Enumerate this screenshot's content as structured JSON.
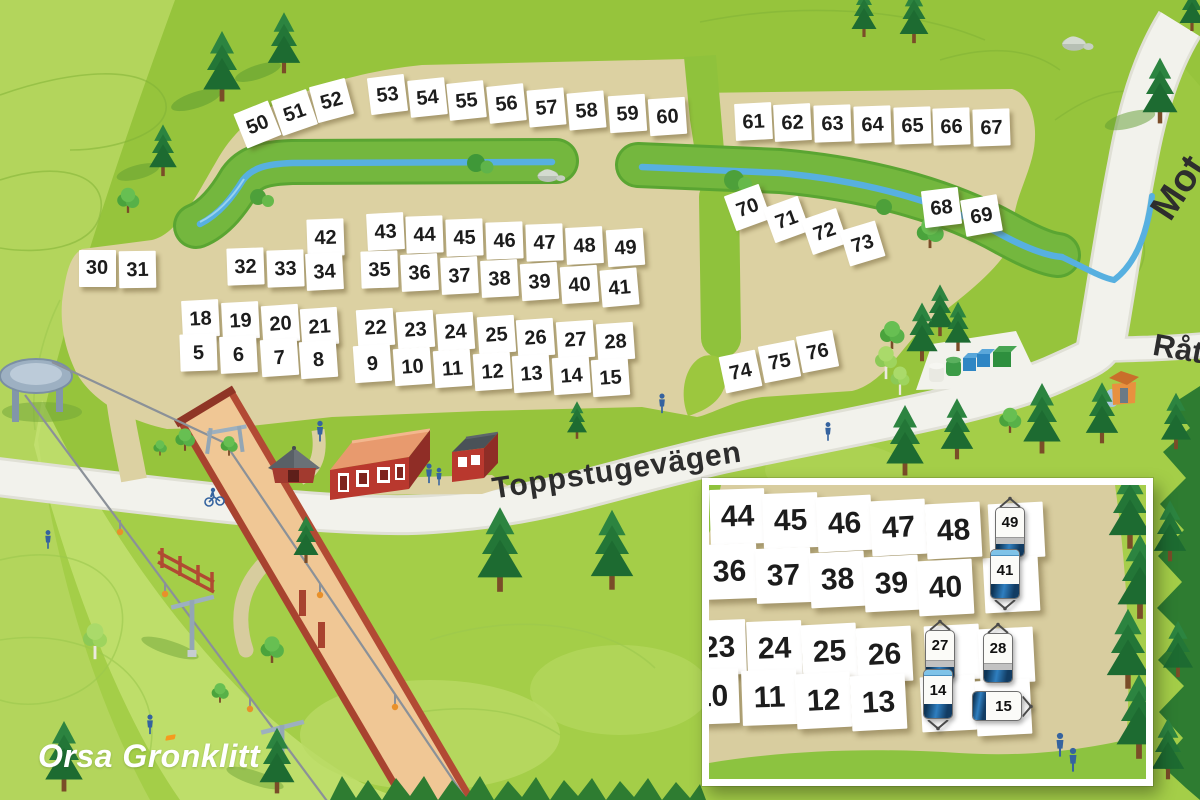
{
  "map": {
    "logo": {
      "text": "Orsa Grönklitt",
      "p1": "Orsa Gr",
      "o": "o",
      "p2": "nklitt"
    },
    "road_labels": {
      "main": "Toppstugevägen",
      "top_right": "Mot",
      "right": "Råt"
    },
    "plots": [
      {
        "n": "50",
        "x": 257,
        "y": 124,
        "r": -22
      },
      {
        "n": "51",
        "x": 294,
        "y": 112,
        "r": -19
      },
      {
        "n": "52",
        "x": 331,
        "y": 100,
        "r": -15
      },
      {
        "n": "53",
        "x": 387,
        "y": 94,
        "r": -7
      },
      {
        "n": "54",
        "x": 427,
        "y": 97,
        "r": -6
      },
      {
        "n": "55",
        "x": 466,
        "y": 100,
        "r": -6
      },
      {
        "n": "56",
        "x": 506,
        "y": 103,
        "r": -6
      },
      {
        "n": "57",
        "x": 546,
        "y": 107,
        "r": -5
      },
      {
        "n": "58",
        "x": 586,
        "y": 110,
        "r": -5
      },
      {
        "n": "59",
        "x": 627,
        "y": 113,
        "r": -4
      },
      {
        "n": "60",
        "x": 667,
        "y": 116,
        "r": -4
      },
      {
        "n": "61",
        "x": 753,
        "y": 121,
        "r": -3
      },
      {
        "n": "62",
        "x": 792,
        "y": 122,
        "r": -3
      },
      {
        "n": "63",
        "x": 832,
        "y": 123,
        "r": -2
      },
      {
        "n": "64",
        "x": 872,
        "y": 124,
        "r": -2
      },
      {
        "n": "65",
        "x": 912,
        "y": 125,
        "r": -2
      },
      {
        "n": "66",
        "x": 951,
        "y": 126,
        "r": -2
      },
      {
        "n": "67",
        "x": 991,
        "y": 127,
        "r": -2
      },
      {
        "n": "68",
        "x": 941,
        "y": 207,
        "r": -7
      },
      {
        "n": "69",
        "x": 981,
        "y": 215,
        "r": -10
      },
      {
        "n": "70",
        "x": 747,
        "y": 207,
        "r": -20
      },
      {
        "n": "71",
        "x": 786,
        "y": 219,
        "r": -20
      },
      {
        "n": "72",
        "x": 824,
        "y": 231,
        "r": -19
      },
      {
        "n": "73",
        "x": 862,
        "y": 243,
        "r": -17
      },
      {
        "n": "42",
        "x": 325,
        "y": 237,
        "r": -2
      },
      {
        "n": "43",
        "x": 385,
        "y": 231,
        "r": -3
      },
      {
        "n": "44",
        "x": 424,
        "y": 234,
        "r": -2
      },
      {
        "n": "45",
        "x": 464,
        "y": 237,
        "r": -2
      },
      {
        "n": "46",
        "x": 504,
        "y": 240,
        "r": -2
      },
      {
        "n": "47",
        "x": 544,
        "y": 242,
        "r": -2
      },
      {
        "n": "48",
        "x": 584,
        "y": 245,
        "r": -3
      },
      {
        "n": "49",
        "x": 625,
        "y": 247,
        "r": -4
      },
      {
        "n": "30",
        "x": 97,
        "y": 268,
        "r": 0
      },
      {
        "n": "31",
        "x": 137,
        "y": 269,
        "r": -1
      },
      {
        "n": "32",
        "x": 245,
        "y": 266,
        "r": -2
      },
      {
        "n": "33",
        "x": 285,
        "y": 268,
        "r": -2
      },
      {
        "n": "34",
        "x": 324,
        "y": 271,
        "r": -3
      },
      {
        "n": "35",
        "x": 379,
        "y": 269,
        "r": -2
      },
      {
        "n": "36",
        "x": 419,
        "y": 272,
        "r": -3
      },
      {
        "n": "37",
        "x": 459,
        "y": 275,
        "r": -3
      },
      {
        "n": "38",
        "x": 499,
        "y": 278,
        "r": -3
      },
      {
        "n": "39",
        "x": 539,
        "y": 281,
        "r": -4
      },
      {
        "n": "40",
        "x": 579,
        "y": 284,
        "r": -4
      },
      {
        "n": "41",
        "x": 619,
        "y": 287,
        "r": -5
      },
      {
        "n": "18",
        "x": 200,
        "y": 318,
        "r": -3
      },
      {
        "n": "19",
        "x": 240,
        "y": 320,
        "r": -3
      },
      {
        "n": "20",
        "x": 280,
        "y": 323,
        "r": -4
      },
      {
        "n": "21",
        "x": 319,
        "y": 326,
        "r": -4
      },
      {
        "n": "5",
        "x": 198,
        "y": 352,
        "r": -2
      },
      {
        "n": "6",
        "x": 238,
        "y": 354,
        "r": -3
      },
      {
        "n": "7",
        "x": 279,
        "y": 357,
        "r": -4
      },
      {
        "n": "8",
        "x": 318,
        "y": 359,
        "r": -4
      },
      {
        "n": "22",
        "x": 375,
        "y": 327,
        "r": -4
      },
      {
        "n": "23",
        "x": 415,
        "y": 329,
        "r": -4
      },
      {
        "n": "24",
        "x": 455,
        "y": 331,
        "r": -4
      },
      {
        "n": "25",
        "x": 496,
        "y": 334,
        "r": -4
      },
      {
        "n": "26",
        "x": 535,
        "y": 337,
        "r": -4
      },
      {
        "n": "27",
        "x": 575,
        "y": 339,
        "r": -4
      },
      {
        "n": "28",
        "x": 615,
        "y": 341,
        "r": -4
      },
      {
        "n": "9",
        "x": 372,
        "y": 363,
        "r": -4
      },
      {
        "n": "10",
        "x": 412,
        "y": 366,
        "r": -4
      },
      {
        "n": "11",
        "x": 452,
        "y": 368,
        "r": -4
      },
      {
        "n": "12",
        "x": 492,
        "y": 371,
        "r": -4
      },
      {
        "n": "13",
        "x": 531,
        "y": 373,
        "r": -4
      },
      {
        "n": "14",
        "x": 571,
        "y": 375,
        "r": -4
      },
      {
        "n": "15",
        "x": 610,
        "y": 377,
        "r": -4
      },
      {
        "n": "74",
        "x": 740,
        "y": 371,
        "r": -12
      },
      {
        "n": "75",
        "x": 779,
        "y": 361,
        "r": -11
      },
      {
        "n": "76",
        "x": 817,
        "y": 351,
        "r": -11
      }
    ]
  },
  "inset": {
    "plots": [
      {
        "n": "44",
        "x": 28,
        "y": 31,
        "r": -2
      },
      {
        "n": "45",
        "x": 81,
        "y": 35,
        "r": -2
      },
      {
        "n": "46",
        "x": 135,
        "y": 38,
        "r": -3
      },
      {
        "n": "47",
        "x": 189,
        "y": 42,
        "r": -3
      },
      {
        "n": "48",
        "x": 244,
        "y": 45,
        "r": -3
      },
      {
        "n": "36",
        "x": 20,
        "y": 86,
        "r": -2
      },
      {
        "n": "37",
        "x": 74,
        "y": 90,
        "r": -2
      },
      {
        "n": "38",
        "x": 128,
        "y": 94,
        "r": -3
      },
      {
        "n": "39",
        "x": 182,
        "y": 98,
        "r": -3
      },
      {
        "n": "40",
        "x": 236,
        "y": 102,
        "r": -3
      },
      {
        "n": "23",
        "x": 9,
        "y": 162,
        "r": -2
      },
      {
        "n": "24",
        "x": 65,
        "y": 163,
        "r": -2
      },
      {
        "n": "25",
        "x": 120,
        "y": 166,
        "r": -3
      },
      {
        "n": "26",
        "x": 175,
        "y": 169,
        "r": -3
      },
      {
        "n": "10",
        "x": 2,
        "y": 211,
        "r": -2
      },
      {
        "n": "11",
        "x": 60,
        "y": 212,
        "r": -2
      },
      {
        "n": "12",
        "x": 114,
        "y": 215,
        "r": -3
      },
      {
        "n": "13",
        "x": 169,
        "y": 217,
        "r": -3
      }
    ],
    "squares": [
      {
        "x": 307,
        "y": 45,
        "r": -3
      },
      {
        "x": 302,
        "y": 99,
        "r": -3
      },
      {
        "x": 243,
        "y": 167,
        "r": -3
      },
      {
        "x": 297,
        "y": 170,
        "r": -3
      },
      {
        "x": 239,
        "y": 218,
        "r": -3
      },
      {
        "x": 294,
        "y": 222,
        "r": -3
      }
    ],
    "caravans": [
      {
        "n": "49",
        "x": 301,
        "y": 42,
        "dir": "up"
      },
      {
        "n": "41",
        "x": 296,
        "y": 95,
        "dir": "down"
      },
      {
        "n": "27",
        "x": 231,
        "y": 165,
        "dir": "up"
      },
      {
        "n": "28",
        "x": 289,
        "y": 168,
        "dir": "up"
      },
      {
        "n": "14",
        "x": 229,
        "y": 215,
        "dir": "down"
      },
      {
        "n": "15",
        "x": 293,
        "y": 221,
        "dir": "right"
      }
    ]
  },
  "colors": {
    "grass": "#96c43c",
    "sand": "#dcd1a2",
    "road": "#f2f2ec",
    "stream": "#57b0e0",
    "plot_bg": "#ffffff",
    "plot_text": "#1c1c1c",
    "logo_text": "#ffffff",
    "logo_accent": "#f59a1e",
    "forest_dark": "#2e7c31"
  },
  "icons": {
    "spruce-tree-icon": "layered-triangles",
    "deciduous-tree-icon": "circle-cluster",
    "birch-tree-icon": "light-circle-cluster",
    "person-icon": "blue-silhouette",
    "caravan-icon": "rounded-rect-with-hitch",
    "rock-icon": "gray-ellipse",
    "recycling-bins-icon": "container-row",
    "ski-lift-icon": "cables-and-towers",
    "bridge-icon": "red-deck-bridge"
  }
}
